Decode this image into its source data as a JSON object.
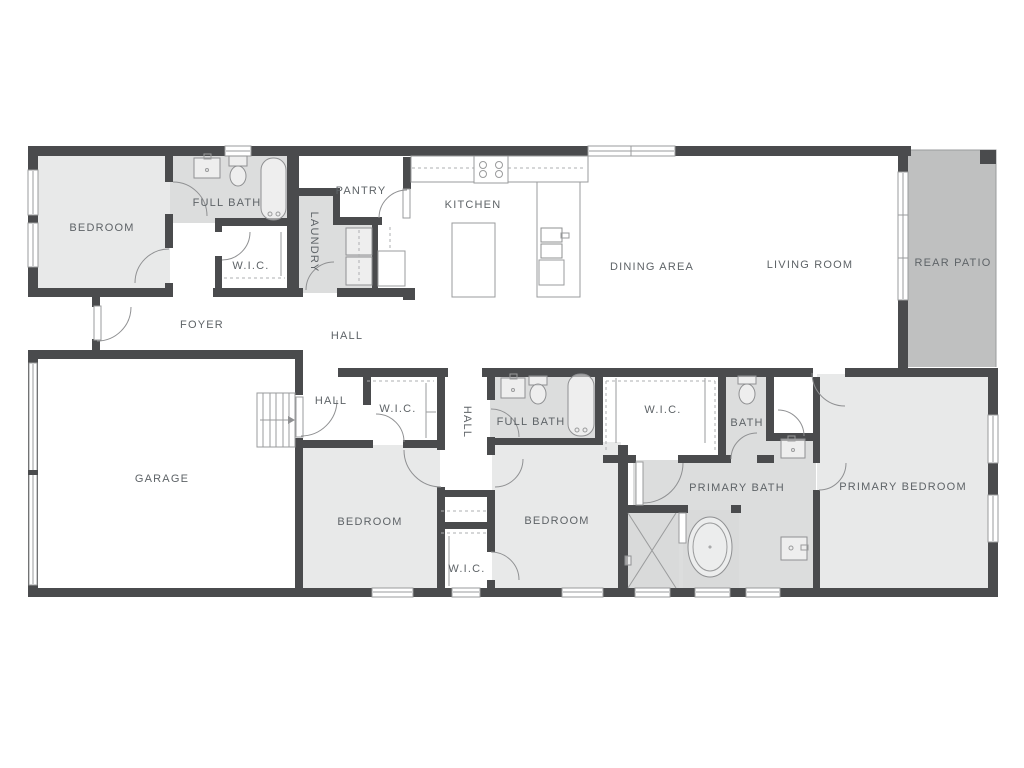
{
  "labels": {
    "bedroom_top": "BEDROOM",
    "full_bath_top": "FULL BATH",
    "wic_top": "W.I.C.",
    "laundry": "LAUNDRY",
    "pantry": "PANTRY",
    "kitchen": "KITCHEN",
    "dining_area": "DINING AREA",
    "living_room": "LIVING ROOM",
    "rear_patio": "REAR PATIO",
    "foyer": "FOYER",
    "hall_upper": "HALL",
    "garage": "GARAGE",
    "hall_lower": "HALL",
    "wic_mid": "W.I.C.",
    "hall_vertical": "HALL",
    "full_bath_lower": "FULL BATH",
    "wic_primary": "W.I.C.",
    "bath": "BATH",
    "bedroom_left": "BEDROOM",
    "bedroom_right": "BEDROOM",
    "wic_bottom": "W.I.C.",
    "primary_bath": "PRIMARY BATH",
    "primary_bedroom": "PRIMARY BEDROOM"
  },
  "colors": {
    "wall": "#4a4b4d",
    "room_light": "#e8e9e9",
    "room_medium": "#dcdddd",
    "room_dark": "#d9dada",
    "patio": "#bfc0c0",
    "line": "#9a9b9c",
    "label": "#5e6367",
    "background": "#ffffff"
  }
}
